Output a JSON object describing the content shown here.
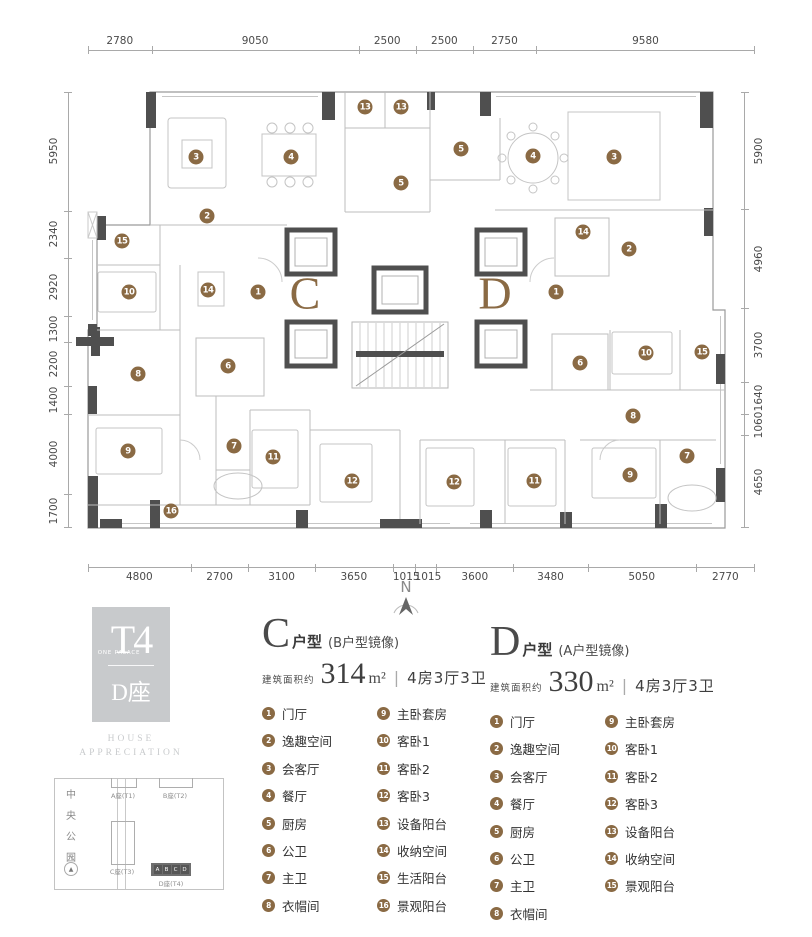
{
  "meta": {
    "project": "T4",
    "project_sub": "ONE PALACE",
    "block": "D座",
    "tagline_line1": "HOUSE",
    "tagline_line2": "APPRECIATION"
  },
  "colors": {
    "accent_brown": "#8a6a44",
    "wall_dark": "#4f4f4f",
    "logo_gray": "#c8cacc"
  },
  "compass": {
    "label": "N"
  },
  "plan": {
    "marker_color": "#8a6a44",
    "unit_labels": {
      "c": "C",
      "d": "D"
    },
    "dimensions": {
      "top": [
        "2780",
        "9050",
        "2500",
        "2500",
        "2750",
        "9580"
      ],
      "bottom": [
        "4800",
        "2700",
        "3100",
        "3650",
        "1015",
        "1015",
        "3600",
        "3480",
        "5050",
        "2770"
      ],
      "left": [
        "5950",
        "2340",
        "2920",
        "1300",
        "2200",
        "1400",
        "4000",
        "1700"
      ],
      "right": [
        "5900",
        "4960",
        "3700",
        "1640",
        "1060",
        "4650"
      ]
    },
    "markers": {
      "c": [
        {
          "n": "1",
          "x": 258,
          "y": 292
        },
        {
          "n": "2",
          "x": 207,
          "y": 216
        },
        {
          "n": "3",
          "x": 196,
          "y": 157
        },
        {
          "n": "4",
          "x": 291,
          "y": 157
        },
        {
          "n": "5",
          "x": 401,
          "y": 183
        },
        {
          "n": "6",
          "x": 228,
          "y": 366
        },
        {
          "n": "7",
          "x": 234,
          "y": 446
        },
        {
          "n": "8",
          "x": 138,
          "y": 374
        },
        {
          "n": "9",
          "x": 128,
          "y": 451
        },
        {
          "n": "10",
          "x": 129,
          "y": 292
        },
        {
          "n": "11",
          "x": 273,
          "y": 457
        },
        {
          "n": "12",
          "x": 352,
          "y": 481
        },
        {
          "n": "13",
          "x": 365,
          "y": 107
        },
        {
          "n": "14",
          "x": 208,
          "y": 290
        },
        {
          "n": "15",
          "x": 122,
          "y": 241
        },
        {
          "n": "16",
          "x": 171,
          "y": 511
        }
      ],
      "d": [
        {
          "n": "1",
          "x": 556,
          "y": 292
        },
        {
          "n": "2",
          "x": 629,
          "y": 249
        },
        {
          "n": "3",
          "x": 614,
          "y": 157
        },
        {
          "n": "4",
          "x": 533,
          "y": 156
        },
        {
          "n": "5",
          "x": 461,
          "y": 149
        },
        {
          "n": "6",
          "x": 580,
          "y": 363
        },
        {
          "n": "7",
          "x": 687,
          "y": 456
        },
        {
          "n": "8",
          "x": 633,
          "y": 416
        },
        {
          "n": "9",
          "x": 630,
          "y": 475
        },
        {
          "n": "10",
          "x": 646,
          "y": 353
        },
        {
          "n": "11",
          "x": 534,
          "y": 481
        },
        {
          "n": "12",
          "x": 454,
          "y": 482
        },
        {
          "n": "13",
          "x": 401,
          "y": 107
        },
        {
          "n": "14",
          "x": 583,
          "y": 232
        },
        {
          "n": "15",
          "x": 702,
          "y": 352
        }
      ]
    }
  },
  "units": [
    {
      "letter": "C",
      "type_suffix": "户型",
      "mirror_note": "(B户型镜像)",
      "area_label": "建筑面积约",
      "area_value": "314",
      "area_unit": "m²",
      "spec_divider": "|",
      "spec": "4房3厅3卫",
      "rooms": [
        "门厅",
        "逸趣空间",
        "会客厅",
        "餐厅",
        "厨房",
        "公卫",
        "主卫",
        "衣帽间",
        "主卧套房",
        "客卧1",
        "客卧2",
        "客卧3",
        "设备阳台",
        "收纳空间",
        "生活阳台",
        "景观阳台"
      ]
    },
    {
      "letter": "D",
      "type_suffix": "户型",
      "mirror_note": "(A户型镜像)",
      "area_label": "建筑面积约",
      "area_value": "330",
      "area_unit": "m²",
      "spec_divider": "|",
      "spec": "4房3厅3卫",
      "rooms": [
        "门厅",
        "逸趣空间",
        "会客厅",
        "餐厅",
        "厨房",
        "公卫",
        "主卫",
        "衣帽间",
        "主卧套房",
        "客卧1",
        "客卧2",
        "客卧3",
        "设备阳台",
        "收纳空间",
        "景观阳台"
      ]
    }
  ],
  "siteplan": {
    "park_label": "中央公园",
    "compass_label": "N",
    "buildings": [
      {
        "label": "A座(T1)"
      },
      {
        "label": "B座(T2)"
      },
      {
        "label": "C座(T3)"
      },
      {
        "label": "D座(T4)"
      }
    ],
    "d_units": [
      "A",
      "B",
      "C",
      "D"
    ]
  }
}
